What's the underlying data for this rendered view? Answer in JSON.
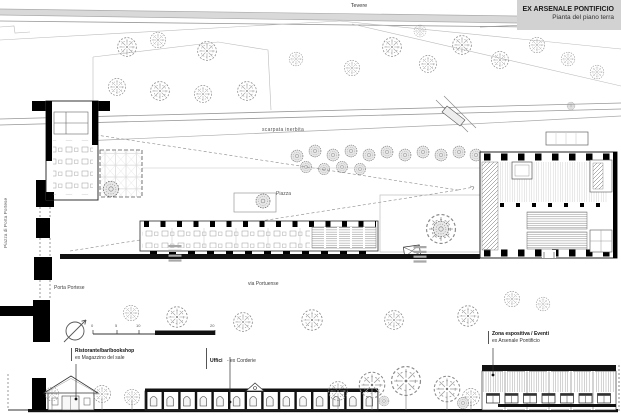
{
  "title_block": {
    "title": "EX ARSENALE PONTIFICIO",
    "subtitle": "Pianta del piano terra"
  },
  "plan_labels": {
    "river": "Tevere",
    "slope": "scarpata inerbita",
    "square": "Piazza",
    "square_left": "Piazza di Porta Portese",
    "gate": "Porta Portese",
    "street": "via Portuense"
  },
  "legend": {
    "restaurant": {
      "name": "Ristorante/bar/bookshop",
      "former": "ex Magazzino del sale"
    },
    "offices": {
      "name": "Uffici",
      "former": "- ex Corderie"
    },
    "exhibition": {
      "name": "Zona espositiva / Eventi",
      "former": "ex Arsenale Pontificio"
    }
  },
  "scale_bar": {
    "ticks": [
      "0",
      "5",
      "10",
      "20"
    ]
  },
  "colors": {
    "paper": "#ffffff",
    "ink": "#111111",
    "wall_black": "#000000",
    "line_gray": "#8a8a8a",
    "faint_gray": "#c8c8c8",
    "titleblock_bg": "#d2d2d2"
  }
}
